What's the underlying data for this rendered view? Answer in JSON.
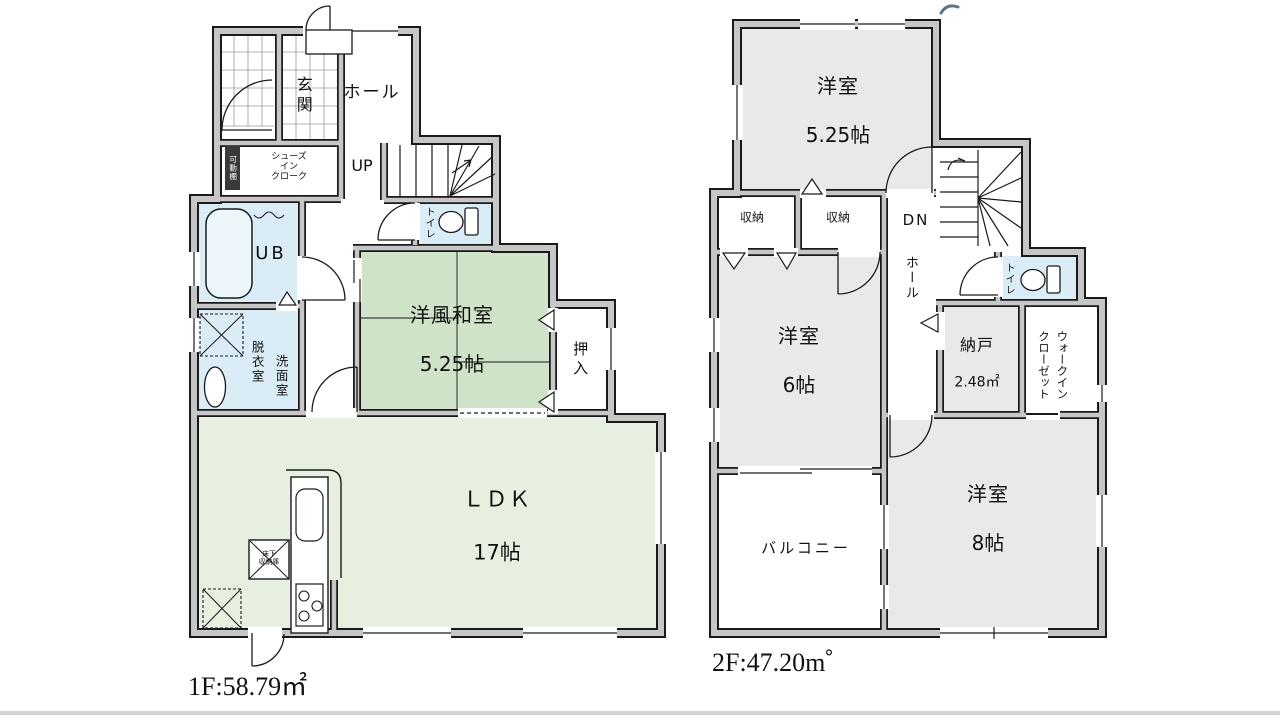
{
  "colors": {
    "outline": "#1a1a1a",
    "wall_fill": "#c6c6c6",
    "washitsu_green": "#cfe3c8",
    "ldk_green": "#e6efe0",
    "water_blue": "#daecf6",
    "tub_blue": "#edf6fb",
    "room_gray": "#e9e9e9",
    "tile_grid": "#9a9a9a",
    "shelf_dark": "#3a3a3a",
    "separator_gray": "#d4d4d4",
    "artifact_blue": "#5a7488",
    "text": "#111111"
  },
  "floor1": {
    "area_label": "1F:58.79㎡",
    "labels": {
      "entrance": "玄関",
      "hall": "ホール",
      "stairs_up": "UP",
      "shoes_in_cloak": "シューズ\nイン\nクローク",
      "movable_shelf": "可動棚",
      "unit_bath": "UB",
      "toilet": "トイレ",
      "dressing_room": "脱衣室",
      "washroom": "洗面室",
      "japanese_room_name": "洋風和室",
      "japanese_room_size": "5.25帖",
      "closet": "押入",
      "underfloor_storage": "床下\n収納庫",
      "ldk_name": "ＬＤＫ",
      "ldk_size": "17帖"
    }
  },
  "floor2": {
    "area_label": "2F:47.20m゜",
    "labels": {
      "bedroom525_name": "洋室",
      "bedroom525_size": "5.25帖",
      "storage_left": "収納",
      "storage_right": "収納",
      "stairs_down": "DN",
      "hall": "ホール",
      "toilet": "トイレ",
      "bedroom6_name": "洋室",
      "bedroom6_size": "6帖",
      "storeroom_name": "納戸",
      "storeroom_size": "2.48㎡",
      "walk_in_closet": "ウォークイン\nクローゼット",
      "balcony": "バルコニー",
      "bedroom8_name": "洋室",
      "bedroom8_size": "8帖"
    }
  }
}
